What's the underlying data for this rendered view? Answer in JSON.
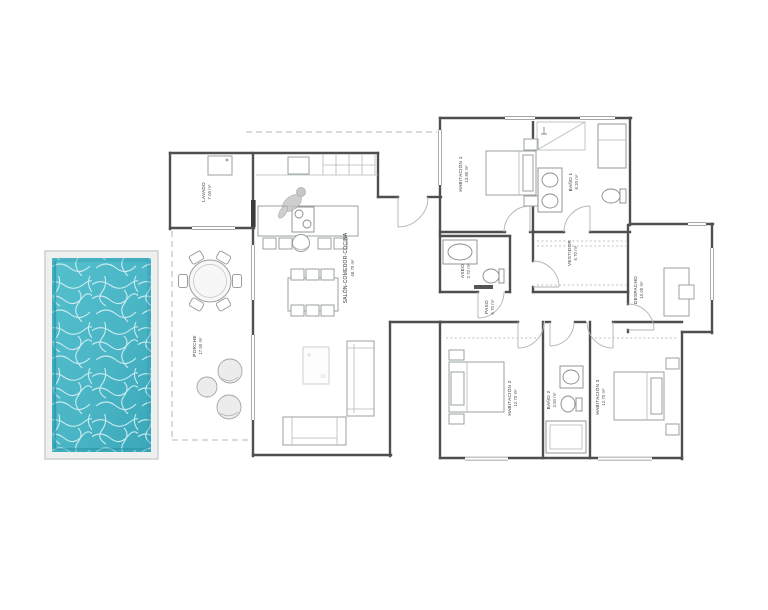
{
  "plan": {
    "rooms": {
      "lavado": {
        "name": "LAVADO",
        "area": "7.00 m²"
      },
      "salon": {
        "name": "SALÓN-COMEDOR-COCINA",
        "area": "48.70 m²"
      },
      "porche": {
        "name": "PORCHE",
        "area": "17.50 m²"
      },
      "habitacion1": {
        "name": "HABITACIÓN 1",
        "area": "13.80 m²"
      },
      "bano1": {
        "name": "BAÑO 1",
        "area": "8.20 m²"
      },
      "vestidor": {
        "name": "VESTIDOR",
        "area": "6.70 m²"
      },
      "aseo": {
        "name": "ASEO",
        "area": "2.70 m²"
      },
      "paso": {
        "name": "PASO",
        "area": "6.70 m²"
      },
      "despacho": {
        "name": "DESPACHO",
        "area": "10.00 m²"
      },
      "habitacion2": {
        "name": "HABITACIÓN 2",
        "area": "12.70 m²"
      },
      "bano2": {
        "name": "BAÑO 2",
        "area": "3.50 m²"
      },
      "habitacion3": {
        "name": "HABITACIÓN 3",
        "area": "12.70 m²"
      }
    }
  },
  "pool": {
    "water_color": "#49b5c5",
    "water_color_dark": "#2f9fb1",
    "caustic_color": "#d8f1f4",
    "frame_color": "#eef0f0"
  },
  "colors": {
    "wall": "#4f4f4f",
    "furniture": "#9aa0a0",
    "dashed": "#b5b5b5",
    "background": "#ffffff",
    "label_text": "#3a3a3a"
  }
}
